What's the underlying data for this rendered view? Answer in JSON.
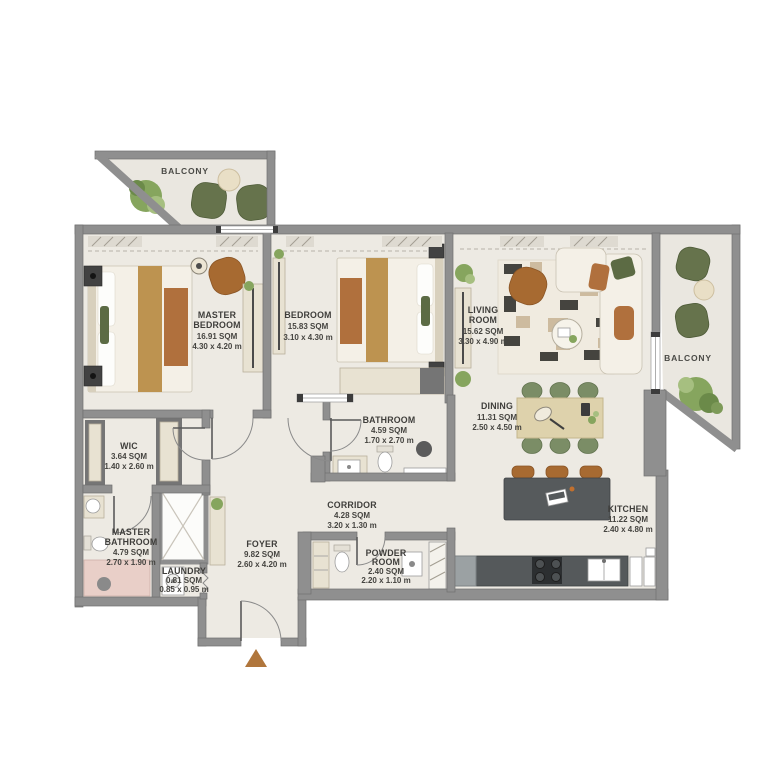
{
  "plan": {
    "type": "apartment-floor-plan",
    "entrance_marker_color": "#b0763c",
    "colors": {
      "wall": "#8f8f8f",
      "floor": "#edeae3",
      "balcony_floor": "#eae7e0",
      "accent_wood": "#bd9350",
      "accent_rust": "#b0703d",
      "chair_green": "#66734c",
      "plant_green": "#86a55e",
      "island_gray": "#565a5c",
      "shower_pink": "#e9cfc8"
    }
  },
  "rooms": {
    "balcony_left": {
      "lines": [
        "BALCONY"
      ]
    },
    "balcony_right": {
      "lines": [
        "BALCONY"
      ]
    },
    "master_bedroom": {
      "lines": [
        "MASTER",
        "BEDROOM",
        "16.91 SQM",
        "4.30 x 4.20 m"
      ]
    },
    "bedroom": {
      "lines": [
        "BEDROOM",
        "15.83 SQM",
        "3.10 x 4.30 m"
      ]
    },
    "living_room": {
      "lines": [
        "LIVING",
        "ROOM",
        "15.62 SQM",
        "3.30 x 4.90 m"
      ]
    },
    "dining": {
      "lines": [
        "DINING",
        "11.31 SQM",
        "2.50 x 4.50 m"
      ]
    },
    "kitchen": {
      "lines": [
        "KITCHEN",
        "11.22 SQM",
        "2.40 x 4.80 m"
      ]
    },
    "wic": {
      "lines": [
        "WIC",
        "3.64 SQM",
        "1.40 x 2.60 m"
      ]
    },
    "bathroom": {
      "lines": [
        "BATHROOM",
        "4.59 SQM",
        "1.70 x 2.70 m"
      ]
    },
    "master_bathroom": {
      "lines": [
        "MASTER",
        "BATHROOM",
        "4.79 SQM",
        "2.70 x 1.90 m"
      ]
    },
    "corridor": {
      "lines": [
        "CORRIDOR",
        "4.28 SQM",
        "3.20 x 1.30 m"
      ]
    },
    "foyer": {
      "lines": [
        "FOYER",
        "9.82 SQM",
        "2.60 x 4.20 m"
      ]
    },
    "laundry": {
      "lines": [
        "LAUNDRY",
        "0.81 SQM",
        "0.85 x 0.95 m"
      ]
    },
    "powder_room": {
      "lines": [
        "POWDER",
        "ROOM",
        "2.40 SQM",
        "2.20 x 1.10 m"
      ]
    }
  }
}
